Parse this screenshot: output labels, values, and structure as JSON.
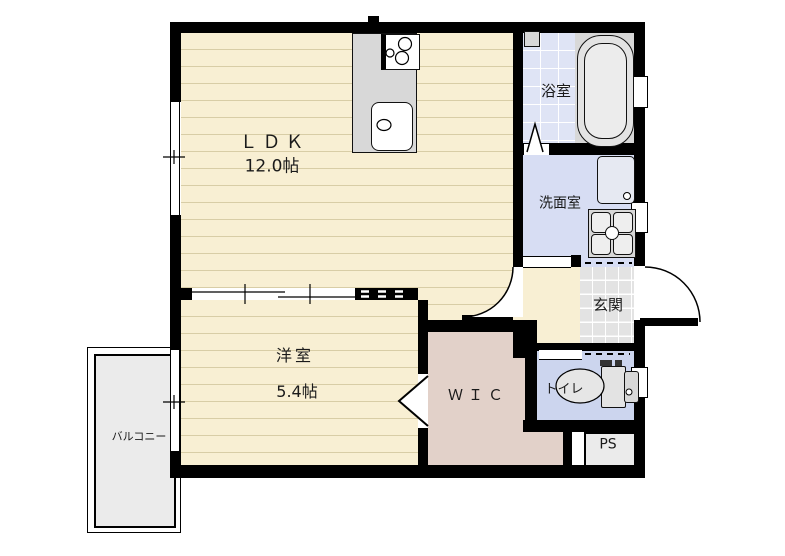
{
  "plan": {
    "type": "apartment-floor-plan",
    "rooms": {
      "ldk": {
        "label": "ＬＤＫ",
        "size": "12.0帖"
      },
      "western": {
        "label": "洋室",
        "size": "5.4帖"
      },
      "bath": {
        "label": "浴室"
      },
      "washroom": {
        "label": "洗面室"
      },
      "entrance": {
        "label": "玄関"
      },
      "toilet": {
        "label": "トイレ"
      },
      "wic": {
        "label": "ＷＩＣ"
      },
      "ps": {
        "label": "PS"
      },
      "balcony": {
        "label": "バルコニー"
      }
    },
    "colors": {
      "wall": "#000000",
      "flooring": "#f8efd3",
      "flooring_line": "#d8cda6",
      "bath_tile": "#dfe4f5",
      "washroom_floor": "#d7ddf3",
      "toilet_floor": "#ccd5ee",
      "wic_floor": "#e2d1c9",
      "entrance_tile": "#e3e3e3",
      "balcony_floor": "#ebebeb",
      "fixture": "#d8d8d8"
    }
  }
}
